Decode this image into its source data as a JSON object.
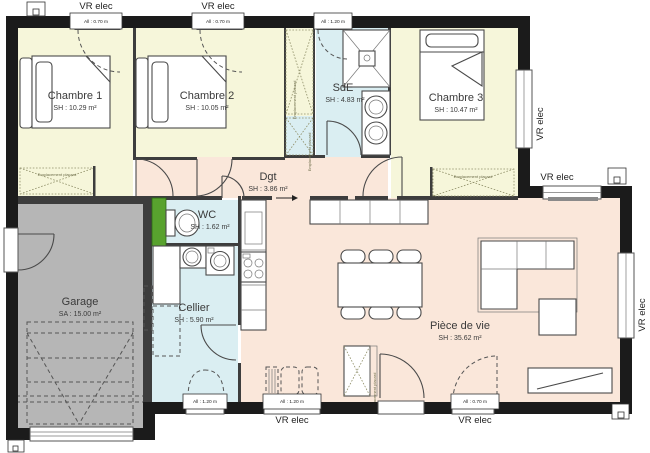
{
  "colors": {
    "wall": "#1b1b1b",
    "bedroom_floor": "#f6f6da",
    "wet_room_floor": "#daeef2",
    "living_floor": "#fae7da",
    "garage_floor": "#b6b6b6",
    "water_heater": "#58a22e"
  },
  "rooms": [
    {
      "name": "Chambre 1",
      "area": "SH : 10.29 m²"
    },
    {
      "name": "Chambre 2",
      "area": "SH : 10.05 m²"
    },
    {
      "name": "SdE",
      "area": "SH : 4.83 m²"
    },
    {
      "name": "Chambre 3",
      "area": "SH : 10.47 m²"
    },
    {
      "name": "Dgt",
      "area": "SH : 3.86 m²"
    },
    {
      "name": "WC",
      "area": "SH : 1.62 m²"
    },
    {
      "name": "Cellier",
      "area": "SH : 5.90 m²"
    },
    {
      "name": "Garage",
      "area": "SA : 15.00 m²"
    },
    {
      "name": "Pièce de vie",
      "area": "SH : 35.62 m²"
    }
  ],
  "annotations": {
    "vr_elec": "VR elec",
    "placard": "Emplacement placard",
    "sill_small": "All : 0.70 m",
    "sill_tall": "All : 1.20 m"
  }
}
